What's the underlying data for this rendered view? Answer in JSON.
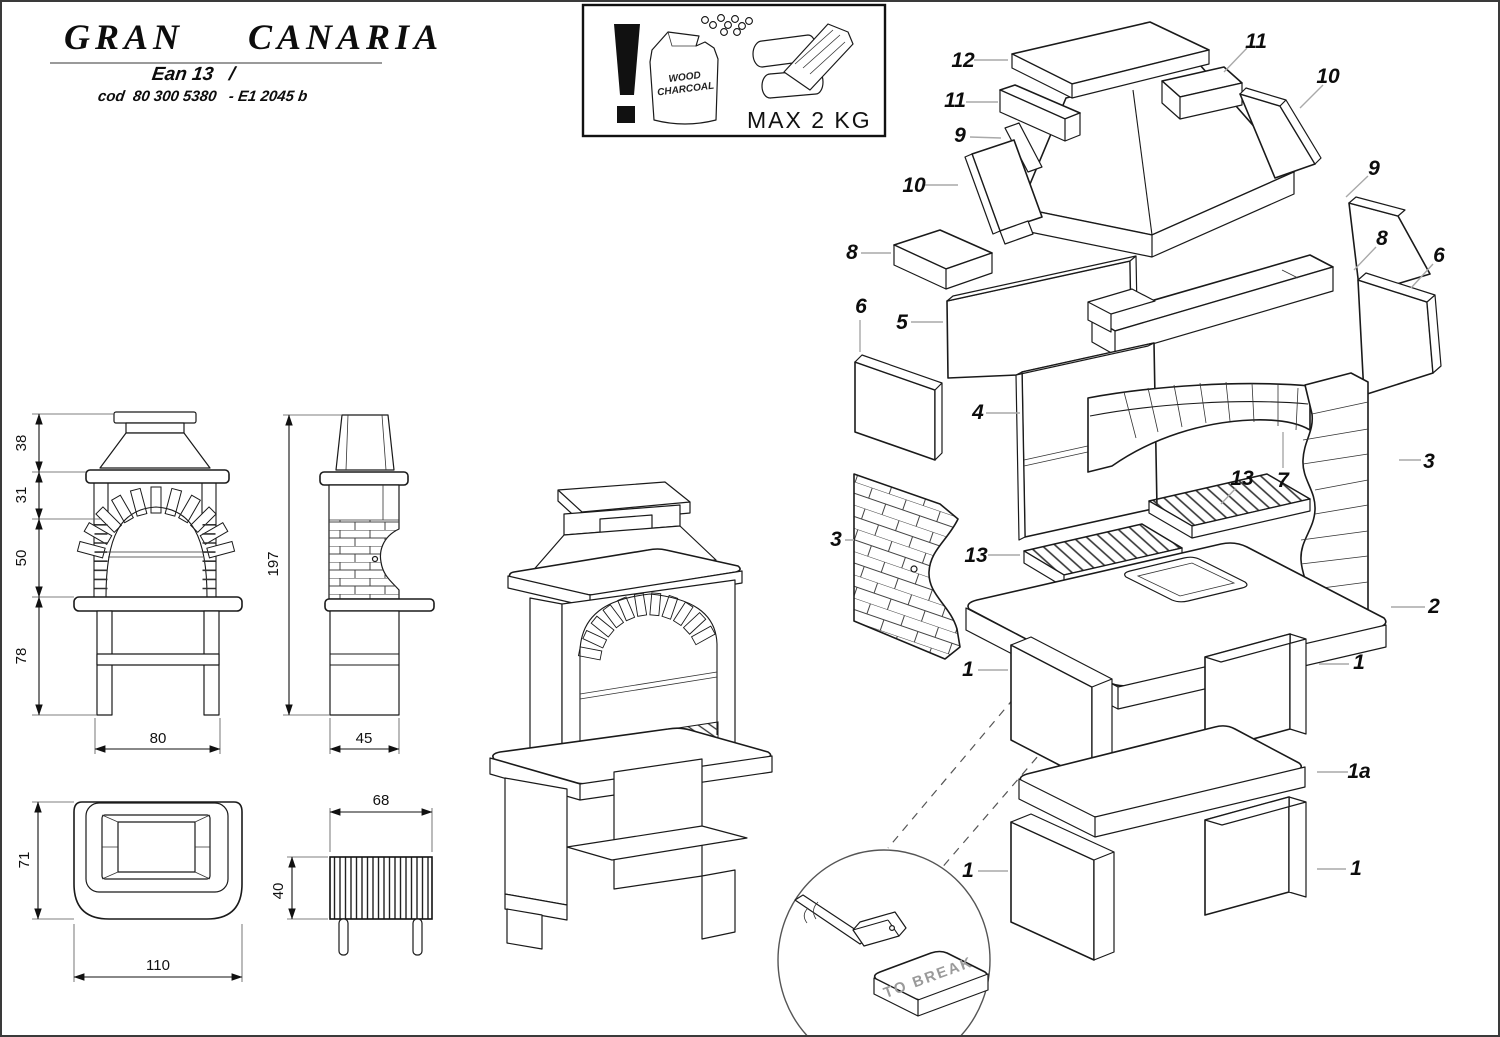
{
  "title_block": {
    "title": "GRAN  CANARIA",
    "ean_line": "Ean 13   /",
    "cod_line": "cod  80 300 5380   - E1 2045 b"
  },
  "warning_box": {
    "bag_line1": "WOOD",
    "bag_line2": "CHARCOAL",
    "max_label": "MAX 2 KG"
  },
  "views": {
    "front": {
      "height_hood": "38",
      "height_arch": "31",
      "height_firebox": "50",
      "height_legs": "78",
      "width": "80"
    },
    "side": {
      "height_total": "197",
      "depth": "45"
    },
    "plan": {
      "depth": "71",
      "width": "110"
    },
    "grate": {
      "width": "68",
      "depth": "40"
    }
  },
  "exploded_labels": {
    "l12": "12",
    "l11a": "11",
    "l11b": "11",
    "l10a": "10",
    "l10b": "10",
    "l9a": "9",
    "l9b": "9",
    "l8a": "8",
    "l8b": "8",
    "l6a": "6",
    "l6b": "6",
    "l5": "5",
    "l4": "4",
    "l3a": "3",
    "l3b": "3",
    "l7": "7",
    "l13a": "13",
    "l13b": "13",
    "l2": "2",
    "l1a": "1",
    "l1b": "1",
    "l1c": "1",
    "l1d": "1",
    "l1shelf": "1a"
  },
  "inset": {
    "to_break": "TO BREAK"
  }
}
